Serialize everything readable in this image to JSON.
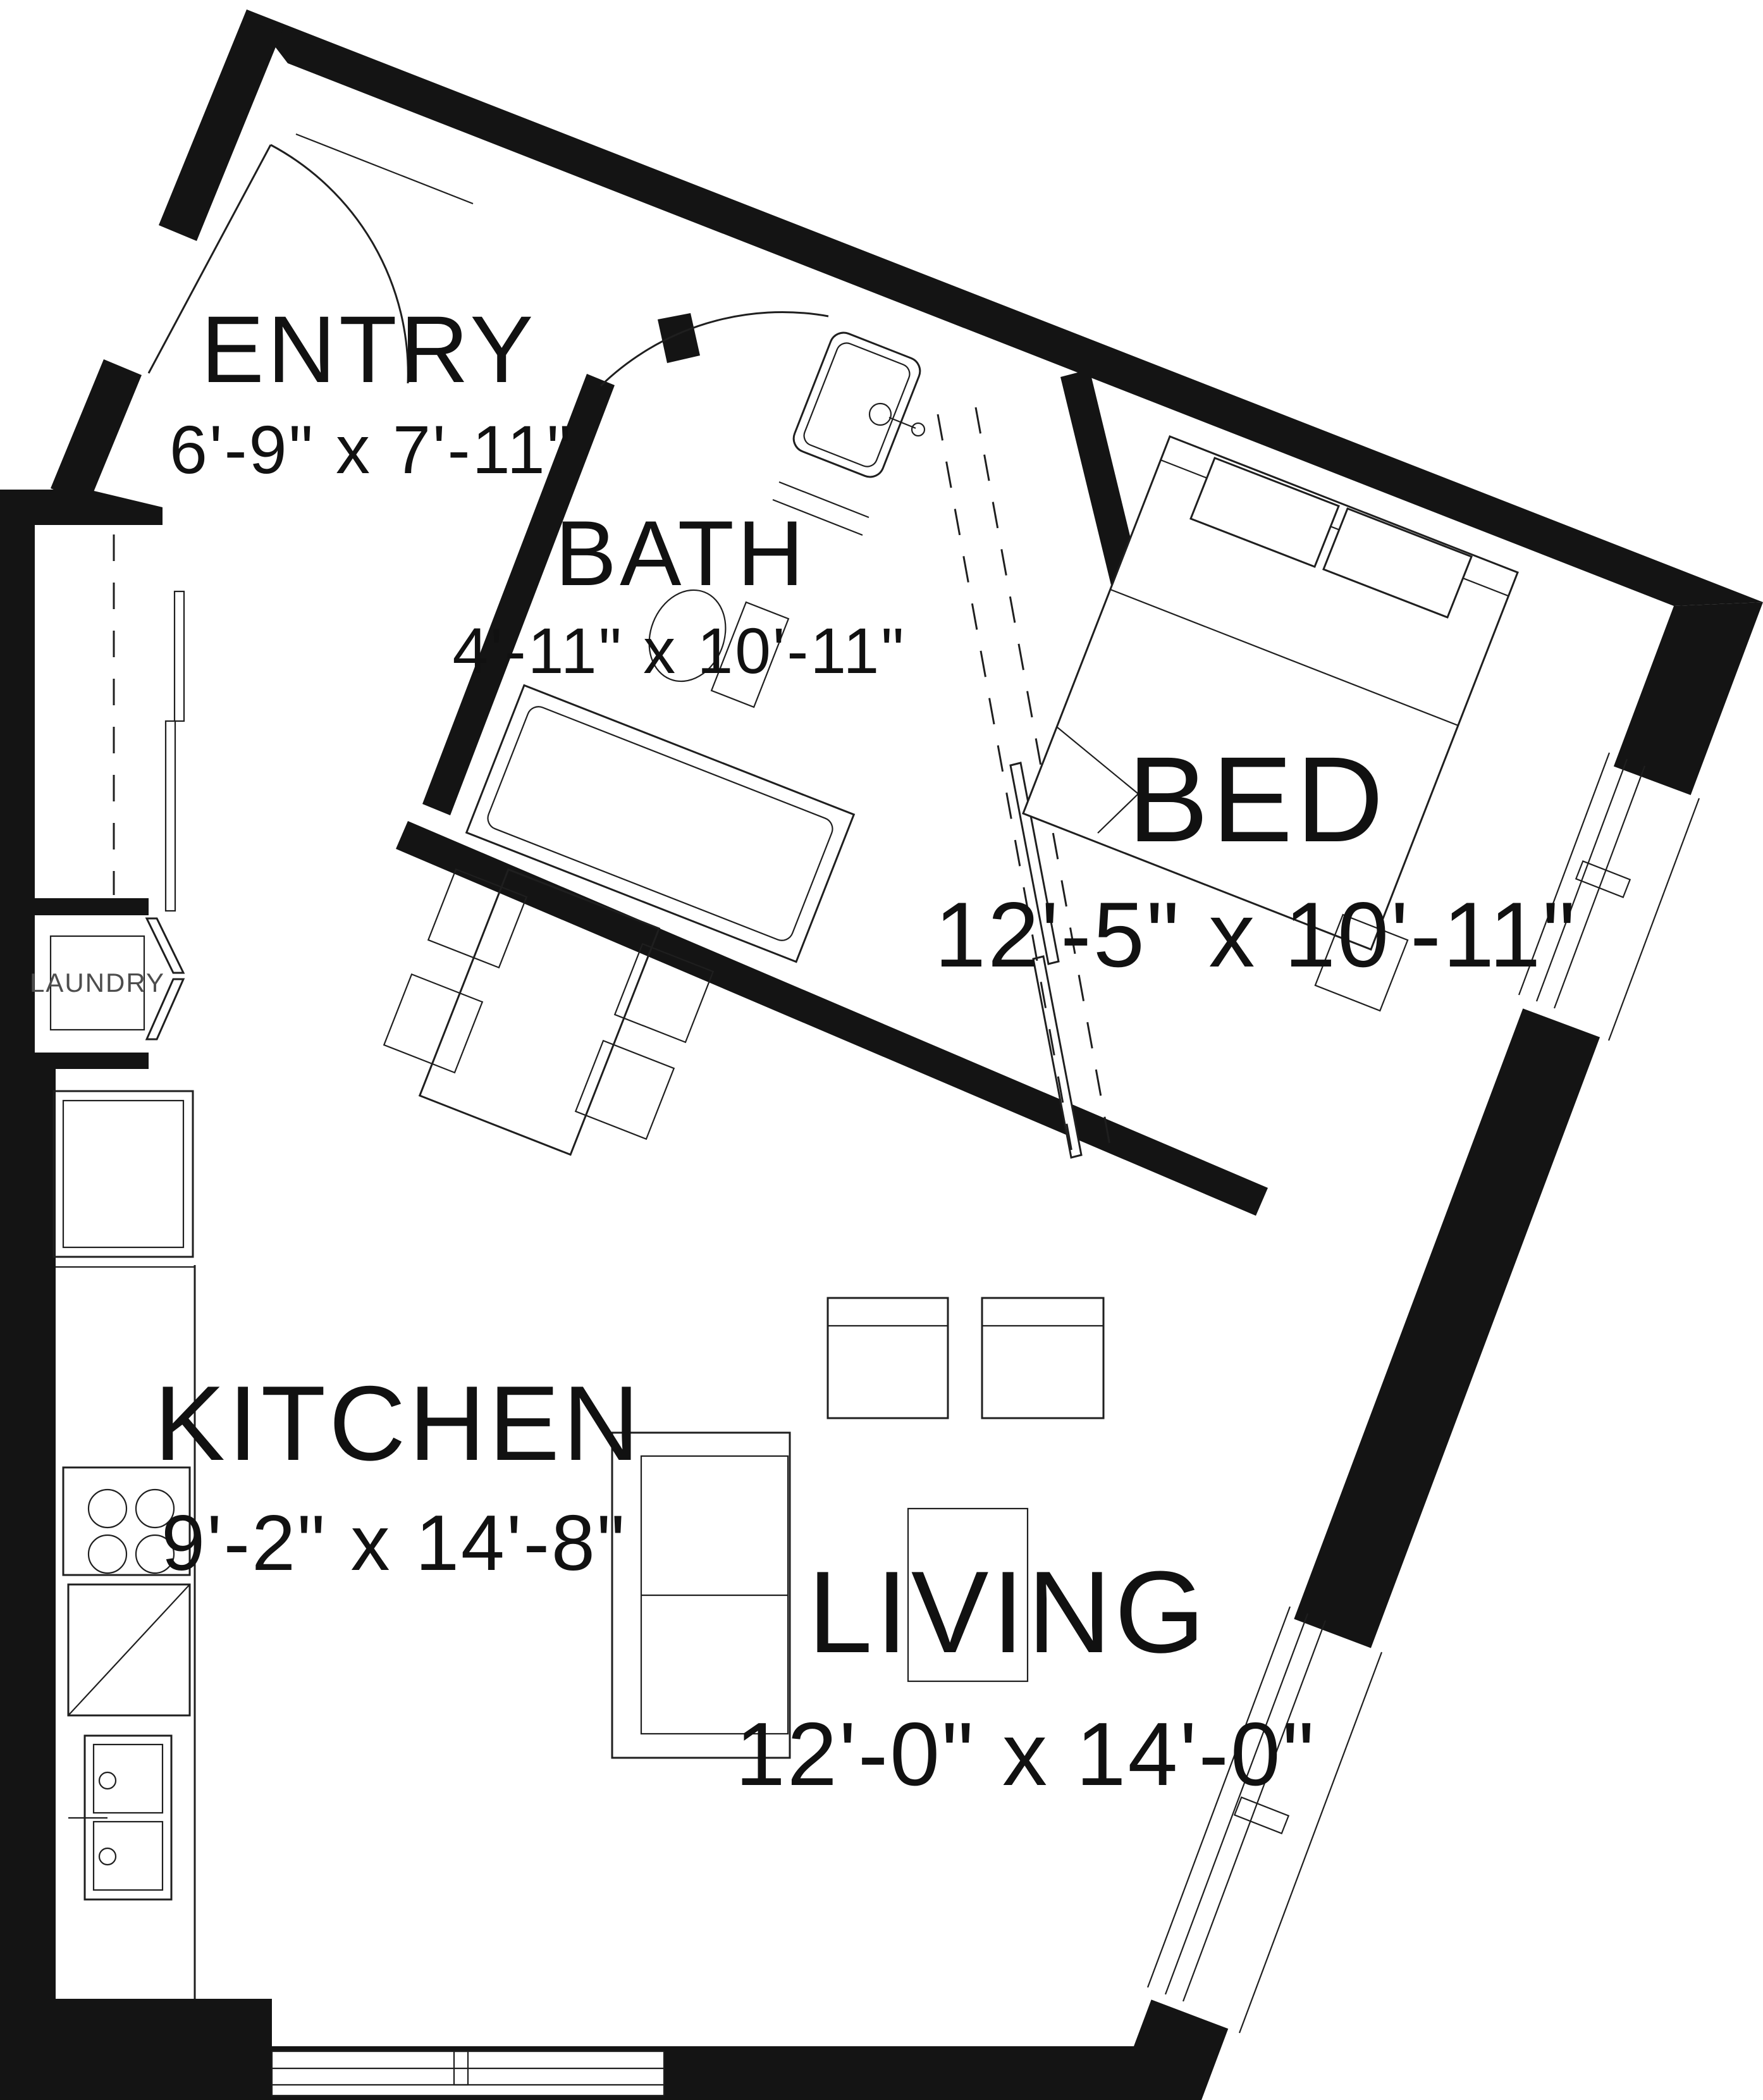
{
  "plan": {
    "type": "apartment-floor-plan",
    "rooms": [
      {
        "name": "ENTRY",
        "dims": "6'-9\" x 7'-11\""
      },
      {
        "name": "BATH",
        "dims": "4'-11\" x 10'-11\""
      },
      {
        "name": "BED",
        "dims": "12'-5\" x 10'-11\""
      },
      {
        "name": "KITCHEN",
        "dims": "9'-2\" x 14'-8\""
      },
      {
        "name": "LIVING",
        "dims": "12'-0\" x 14'-0\""
      }
    ],
    "labels": {
      "laundry": "LAUNDRY"
    },
    "colors": {
      "wall": "#141414",
      "line": "#1f1f1f",
      "laundry_text": "#4d4d4d",
      "background": "#ffffff"
    }
  }
}
